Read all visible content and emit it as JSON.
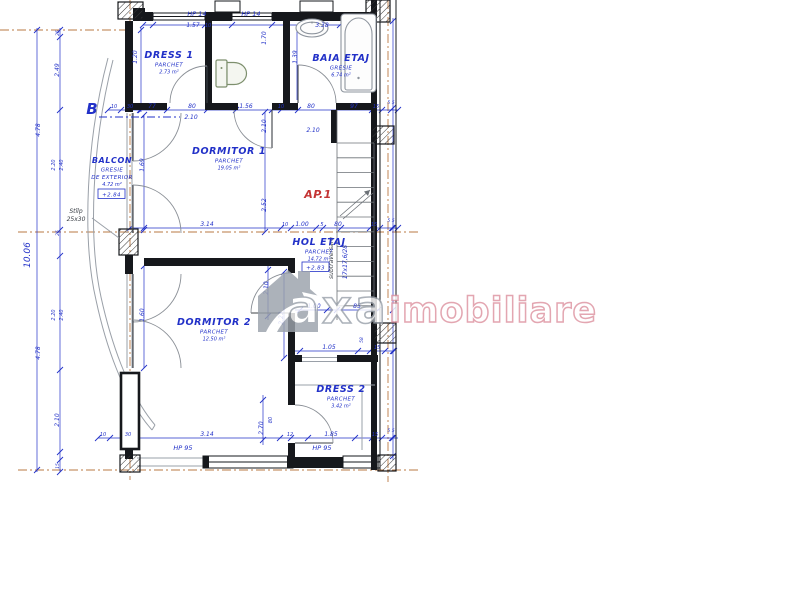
{
  "drawing": {
    "unit_label": "AP.1",
    "section_marker": "B",
    "column_note": [
      "Stîlp",
      "25x30"
    ],
    "stair_note": "17x17,6/28",
    "stair_note2": "subtraversare",
    "watermark": {
      "first": "axa",
      "rest": "imobiliare"
    },
    "colors": {
      "dimension_blue": "#2231c8",
      "axis_brown": "#b26a2f",
      "unit_red": "#c43434",
      "watermark_gray": "#9ba2ab",
      "watermark_pink": "#dd93a0",
      "wall_black": "#16181c"
    },
    "rooms": [
      {
        "id": "dress1",
        "name": "DRESS 1",
        "finish": "PARCHET",
        "area": "2.73 m²",
        "x": 169,
        "y": 58
      },
      {
        "id": "baia-etaj",
        "name": "BAIA ETAJ",
        "finish": "GRESIE",
        "area": "6.74 m²",
        "x": 341,
        "y": 61
      },
      {
        "id": "dormitor1",
        "name": "DORMITOR 1",
        "finish": "PARCHET",
        "area": "19.05 m²",
        "x": 229,
        "y": 154
      },
      {
        "id": "hol-etaj",
        "name": "HOL ETAJ",
        "finish": "PARCHET",
        "area": "14.72 m²",
        "level": "+2.83",
        "x": 319,
        "y": 245
      },
      {
        "id": "dormitor2",
        "name": "DORMITOR 2",
        "finish": "PARCHET",
        "area": "12.50 m²",
        "x": 214,
        "y": 325
      },
      {
        "id": "dress2",
        "name": "DRESS 2",
        "finish": "PARCHET",
        "area": "3.42 m²",
        "x": 341,
        "y": 392
      },
      {
        "id": "balcon",
        "name": "BALCON",
        "finish": "GRESIE",
        "sub": "DE EXTERIOR",
        "area": "4.72 m²",
        "level": "+2.84",
        "x": 112,
        "y": 163,
        "small": true
      }
    ],
    "dims": [
      {
        "x": 197,
        "y": 16,
        "t": "HP 14",
        "s": 6.5
      },
      {
        "x": 193,
        "y": 27,
        "t": "1.57"
      },
      {
        "x": 208,
        "y": 27,
        "t": "10",
        "s": 5
      },
      {
        "x": 251,
        "y": 16,
        "t": "HP 14",
        "s": 6.5
      },
      {
        "x": 322,
        "y": 27,
        "t": "3.38"
      },
      {
        "x": 137,
        "y": 57,
        "t": "1.20",
        "r": 1
      },
      {
        "x": 266,
        "y": 38,
        "t": "1.70",
        "r": 1
      },
      {
        "x": 297,
        "y": 57,
        "t": "1.39",
        "r": 1
      },
      {
        "x": 114,
        "y": 108,
        "t": "10",
        "s": 5
      },
      {
        "x": 130,
        "y": 108,
        "t": "30",
        "s": 5
      },
      {
        "x": 152,
        "y": 108,
        "t": "77"
      },
      {
        "x": 192,
        "y": 108,
        "t": "80"
      },
      {
        "x": 191,
        "y": 119,
        "t": "2.10"
      },
      {
        "x": 246,
        "y": 108,
        "t": "1.56"
      },
      {
        "x": 281,
        "y": 108,
        "t": "10",
        "s": 5
      },
      {
        "x": 311,
        "y": 108,
        "t": "80"
      },
      {
        "x": 354,
        "y": 108,
        "t": "97"
      },
      {
        "x": 376,
        "y": 108,
        "t": "15",
        "s": 5
      },
      {
        "x": 391,
        "y": 104,
        "t": "5 5",
        "s": 4.5
      },
      {
        "x": 313,
        "y": 132,
        "t": "2.10"
      },
      {
        "x": 144,
        "y": 165,
        "t": "1.69",
        "r": 1
      },
      {
        "x": 266,
        "y": 126,
        "t": "2.10",
        "r": 1
      },
      {
        "x": 266,
        "y": 205,
        "t": "2.52",
        "r": 1
      },
      {
        "x": 207,
        "y": 226,
        "t": "3.14"
      },
      {
        "x": 285,
        "y": 226,
        "t": "10",
        "s": 5
      },
      {
        "x": 302,
        "y": 226,
        "t": "1.00"
      },
      {
        "x": 322,
        "y": 226,
        "t": "5",
        "s": 5
      },
      {
        "x": 338,
        "y": 226,
        "t": "80"
      },
      {
        "x": 374,
        "y": 226,
        "t": "15",
        "s": 5
      },
      {
        "x": 391,
        "y": 222,
        "t": "5 5",
        "s": 4.5
      },
      {
        "x": 314,
        "y": 308,
        "t": "1.00"
      },
      {
        "x": 357,
        "y": 308,
        "t": "85"
      },
      {
        "x": 363,
        "y": 340,
        "t": "58",
        "r": 1,
        "s": 4.5
      },
      {
        "x": 329,
        "y": 349,
        "t": "1.05"
      },
      {
        "x": 377,
        "y": 349,
        "t": "15",
        "s": 5
      },
      {
        "x": 268,
        "y": 288,
        "t": "2.10",
        "r": 1
      },
      {
        "x": 144,
        "y": 315,
        "t": "1.60",
        "r": 1
      },
      {
        "x": 283,
        "y": 318,
        "t": "2.23",
        "r": 1
      },
      {
        "x": 263,
        "y": 428,
        "t": "2.70",
        "r": 1
      },
      {
        "x": 272,
        "y": 420,
        "t": "80",
        "r": 1,
        "s": 5
      },
      {
        "x": 103,
        "y": 436,
        "t": "10",
        "s": 5
      },
      {
        "x": 128,
        "y": 436,
        "t": "30",
        "s": 5
      },
      {
        "x": 207,
        "y": 436,
        "t": "3.14"
      },
      {
        "x": 290,
        "y": 436,
        "t": "12",
        "s": 5
      },
      {
        "x": 331,
        "y": 436,
        "t": "1.85"
      },
      {
        "x": 375,
        "y": 436,
        "t": "15",
        "s": 5
      },
      {
        "x": 391,
        "y": 432,
        "t": "5 5",
        "s": 4.5
      },
      {
        "x": 183,
        "y": 450,
        "t": "HP 95",
        "s": 6.5
      },
      {
        "x": 322,
        "y": 450,
        "t": "HP 95",
        "s": 6.5
      },
      {
        "x": 30,
        "y": 255,
        "t": "10.06",
        "r": 1,
        "s": 9
      },
      {
        "x": 40,
        "y": 130,
        "t": "4.78",
        "r": 1
      },
      {
        "x": 40,
        "y": 353,
        "t": "4.78",
        "r": 1
      },
      {
        "x": 59,
        "y": 33,
        "t": "25",
        "r": 1,
        "s": 4.5
      },
      {
        "x": 59,
        "y": 70,
        "t": "2.49",
        "r": 1
      },
      {
        "x": 55,
        "y": 165,
        "t": "2.20",
        "r": 1,
        "s": 5
      },
      {
        "x": 63,
        "y": 165,
        "t": "2.40",
        "r": 1,
        "s": 5
      },
      {
        "x": 59,
        "y": 233,
        "t": "25",
        "r": 1,
        "s": 4.5
      },
      {
        "x": 55,
        "y": 315,
        "t": "2.20",
        "r": 1,
        "s": 5
      },
      {
        "x": 63,
        "y": 315,
        "t": "2.40",
        "r": 1,
        "s": 5
      },
      {
        "x": 59,
        "y": 420,
        "t": "2.10",
        "r": 1
      },
      {
        "x": 59,
        "y": 466,
        "t": "15",
        "r": 1,
        "s": 4.5
      }
    ]
  }
}
